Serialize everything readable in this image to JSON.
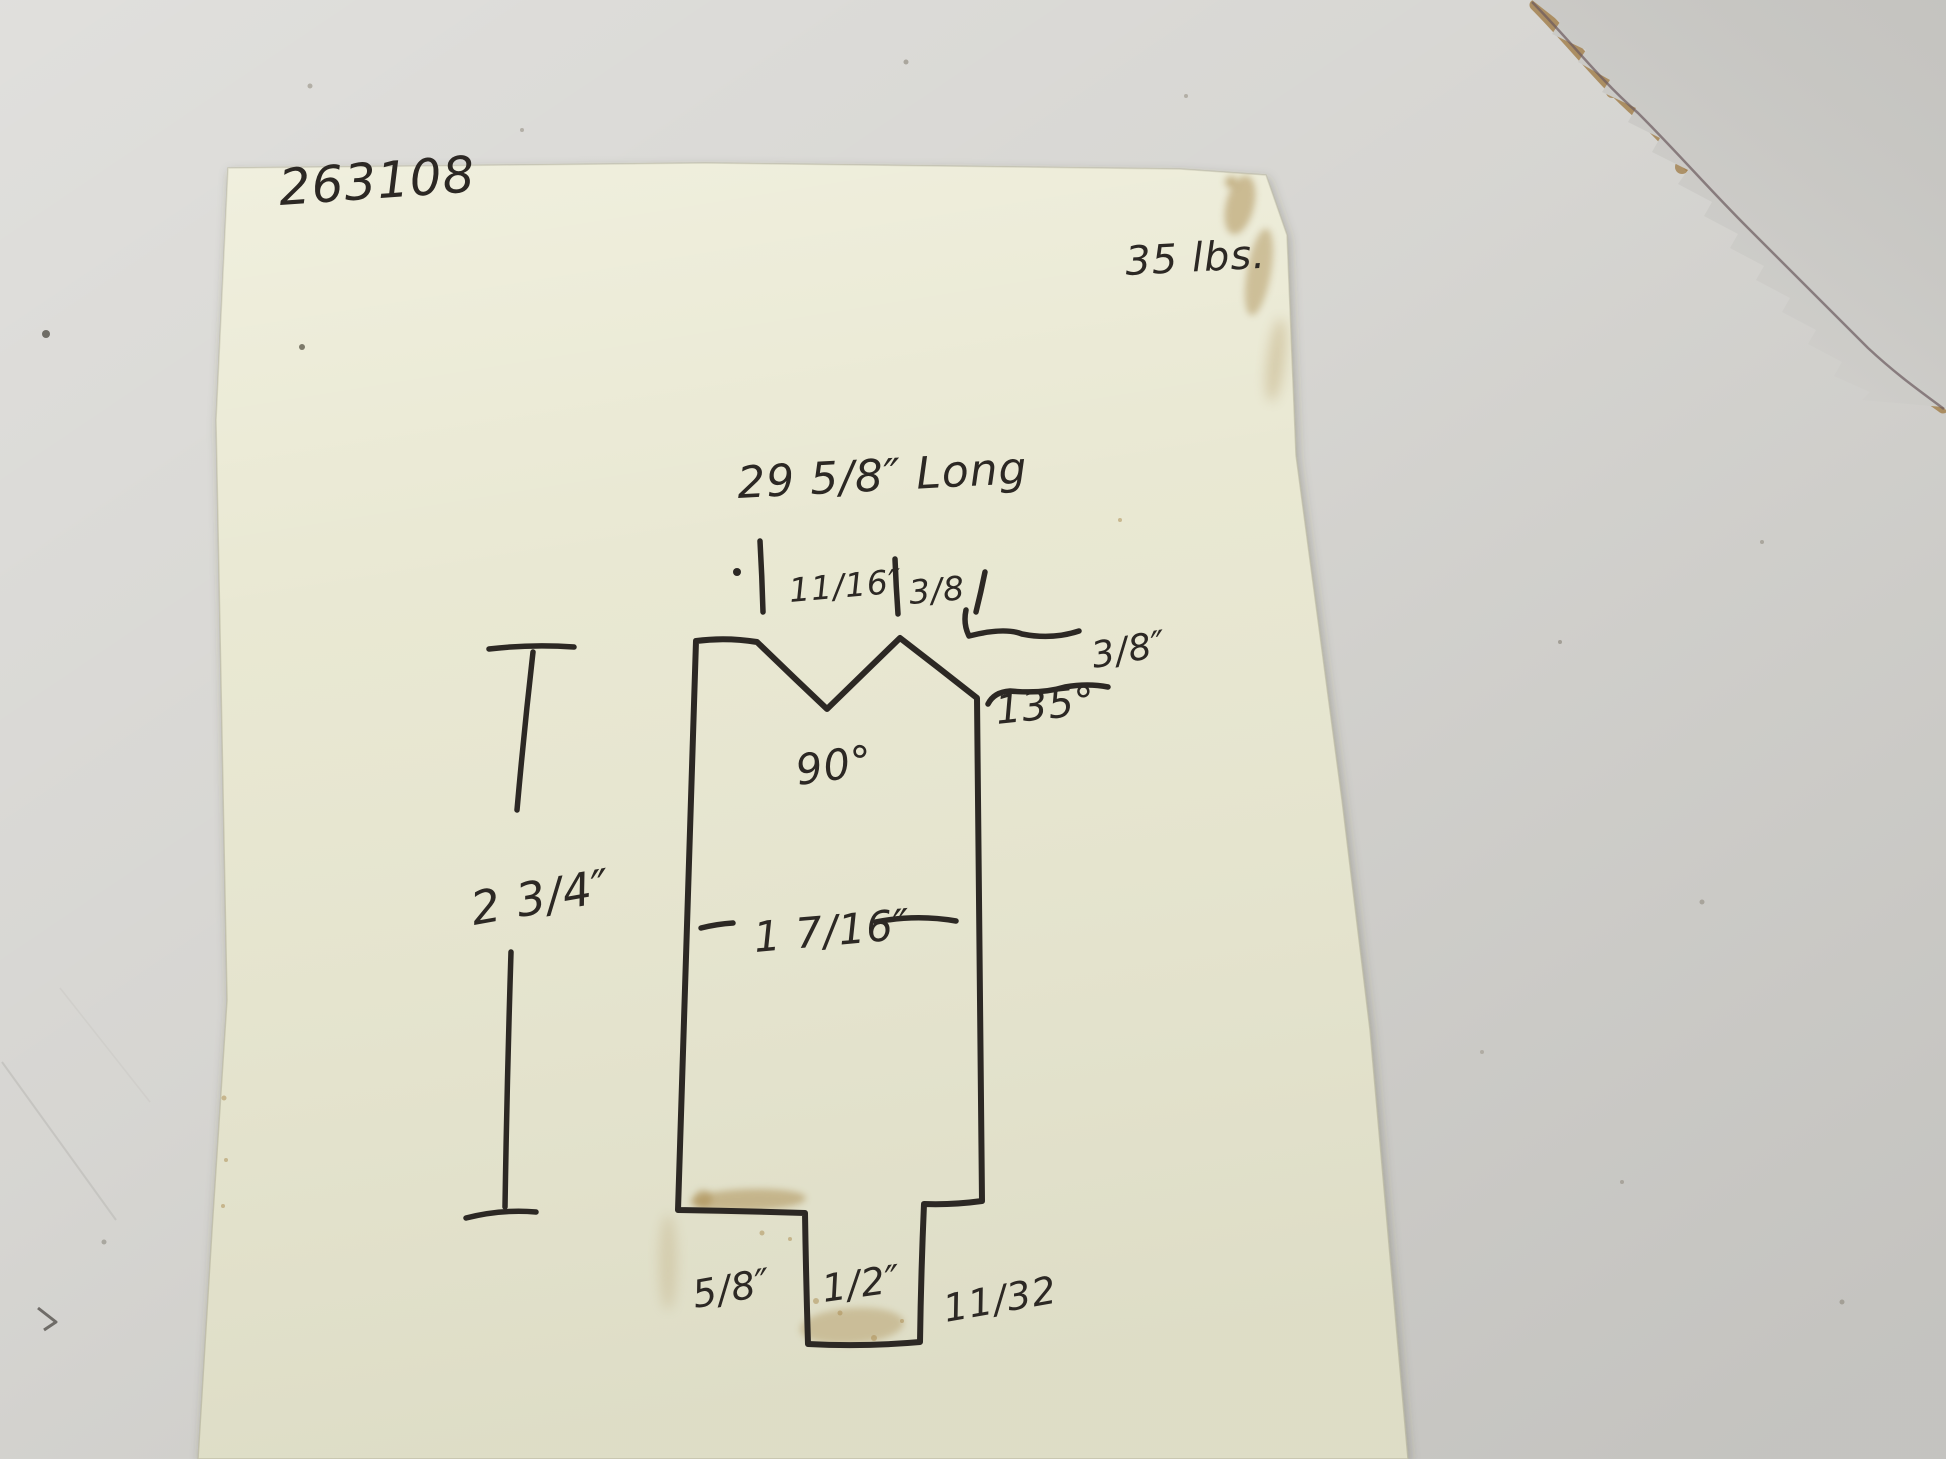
{
  "colors": {
    "background": "#d3d2ce",
    "paper": "#e8e7d1",
    "torn_sheet": "#d1d0cc",
    "torn_fiber": "#a3814f",
    "torn_line": "#6b5a5e",
    "ink": "#2c2824",
    "stain": "#a98a4e"
  },
  "paper": {
    "part_number": "263108",
    "weight": "35 lbs.",
    "dimensions": {
      "overall_length": "29 5/8″ Long",
      "notch_left": "11/16″",
      "notch_right": "3/8",
      "relief_depth": "3/8″",
      "relief_angle": "135°",
      "vee_angle": "90°",
      "overall_height": "2 3/4″",
      "body_width": "1 7/16″",
      "heel_width": "5/8″",
      "tang_width": "1/2″",
      "tang_height": "11/32"
    }
  }
}
